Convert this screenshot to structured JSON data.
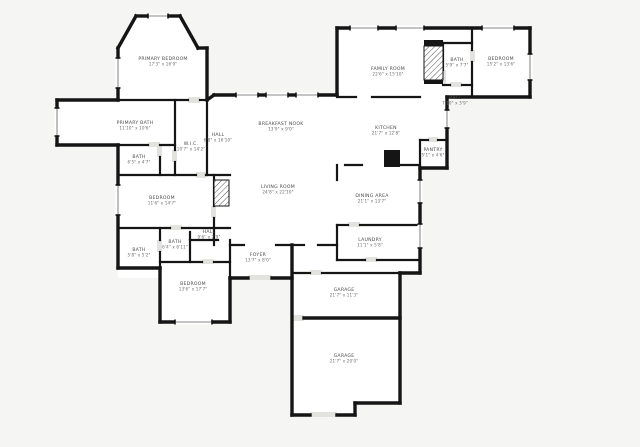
{
  "plan": {
    "title": "floor-plan",
    "colors": {
      "page_background": "#f5f5f3",
      "floor": "#ffffff",
      "wall": "#151515",
      "window": "#8a8a8a",
      "door": "#e2e2de",
      "hatch": "#555555"
    },
    "rooms": [
      {
        "id": "primary-bedroom",
        "name": "PRIMARY BEDROOM",
        "dims": "17'3\" x 16'9\"",
        "x": 163,
        "y": 60
      },
      {
        "id": "primary-bath",
        "name": "PRIMARY BATH",
        "dims": "11'10\" x 10'6\"",
        "x": 135,
        "y": 124
      },
      {
        "id": "bath-1",
        "name": "BATH",
        "dims": "6'5\" x 4'7\"",
        "x": 139,
        "y": 158
      },
      {
        "id": "wic",
        "name": "W.I.C.",
        "dims": "10'7\" x 14'2\"",
        "x": 191,
        "y": 145
      },
      {
        "id": "hall-1",
        "name": "HALL",
        "dims": "6'8\" x 16'10\"",
        "x": 218,
        "y": 136
      },
      {
        "id": "breakfast-nook",
        "name": "BREAKFAST NOOK",
        "dims": "13'9\" x 9'0\"",
        "x": 281,
        "y": 125
      },
      {
        "id": "family-room",
        "name": "FAMILY ROOM",
        "dims": "22'6\" x 15'10\"",
        "x": 388,
        "y": 70
      },
      {
        "id": "bath-2",
        "name": "BATH",
        "dims": "5'9\" x 7'7\"",
        "x": 457,
        "y": 61
      },
      {
        "id": "bedroom-2",
        "name": "BEDROOM",
        "dims": "15'2\" x 13'6\"",
        "x": 501,
        "y": 60
      },
      {
        "id": "hall-2",
        "name": "HALL",
        "dims": "7'10\" x 3'9\"",
        "x": 455,
        "y": 99
      },
      {
        "id": "kitchen",
        "name": "KITCHEN",
        "dims": "21'7\" x 12'8\"",
        "x": 386,
        "y": 129
      },
      {
        "id": "pantry",
        "name": "PANTRY",
        "dims": "5'1\" x 4'6\"",
        "x": 433,
        "y": 151
      },
      {
        "id": "bedroom-3",
        "name": "BEDROOM",
        "dims": "11'6\" x 14'7\"",
        "x": 162,
        "y": 199
      },
      {
        "id": "living-room",
        "name": "LIVING ROOM",
        "dims": "24'8\" x 22'10\"",
        "x": 278,
        "y": 188
      },
      {
        "id": "dining-area",
        "name": "DINING AREA",
        "dims": "21'1\" x 13'7\"",
        "x": 372,
        "y": 197
      },
      {
        "id": "hall-3",
        "name": "HALL",
        "dims": "9'6\" x 2'9\"",
        "x": 209,
        "y": 233
      },
      {
        "id": "bath-3",
        "name": "BATH",
        "dims": "6'4\" x 6'11\"",
        "x": 175,
        "y": 243
      },
      {
        "id": "bath-4",
        "name": "BATH",
        "dims": "5'8\" x 5'2\"",
        "x": 139,
        "y": 251
      },
      {
        "id": "foyer",
        "name": "FOYER",
        "dims": "13'7\" x 8'0\"",
        "x": 258,
        "y": 256
      },
      {
        "id": "laundry",
        "name": "LAUNDRY",
        "dims": "11'1\" x 5'8\"",
        "x": 370,
        "y": 241
      },
      {
        "id": "bedroom-4",
        "name": "BEDROOM",
        "dims": "13'6\" x 17'7\"",
        "x": 193,
        "y": 285
      },
      {
        "id": "garage-1",
        "name": "GARAGE",
        "dims": "21'7\" x 11'3\"",
        "x": 344,
        "y": 291
      },
      {
        "id": "garage-2",
        "name": "GARAGE",
        "dims": "21'7\" x 20'0\"",
        "x": 344,
        "y": 357
      }
    ]
  }
}
